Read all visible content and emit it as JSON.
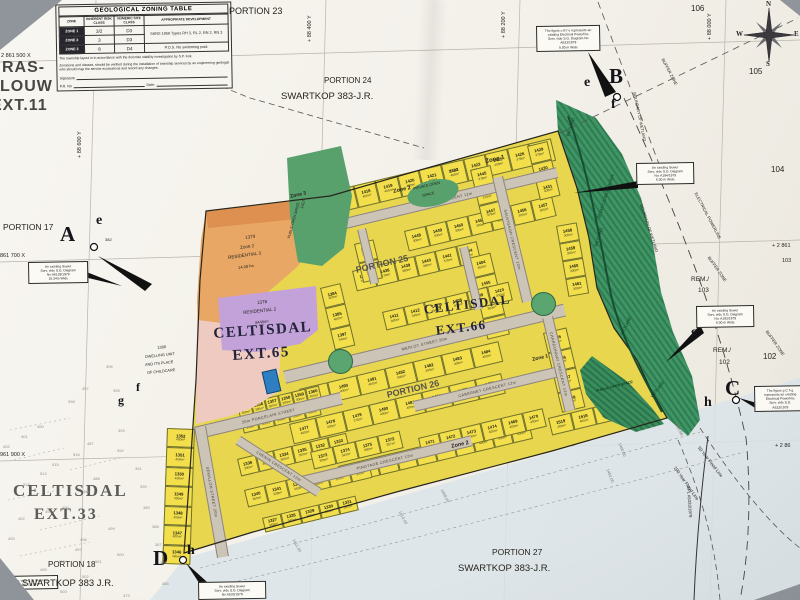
{
  "colors": {
    "plot_yellow": "#f2df4b",
    "street_grey": "#ccc4b6",
    "wetland_green": "#3f9565",
    "zone_orange": "#e9a766",
    "residential2_purple": "#c3a1d9",
    "erf1380_pink": "#efcac1",
    "open_space_green": "#58a06c",
    "special_blue": "#2e7fc2",
    "flood_wash": "#dbe4ea"
  },
  "zoning_table": {
    "title": "GEOLOGICAL ZONING TABLE",
    "col_headers": [
      "ZONE",
      "INHERENT RISK CLASS",
      "NUMERIC SITE CLASS",
      "APPROPRIATE DEVELOPMENT"
    ],
    "rows": [
      [
        "ZONE 1",
        "3/2",
        "D3"
      ],
      [
        "ZONE 2",
        "3",
        "D3"
      ],
      [
        "ZONE 3",
        "8",
        "D4"
      ]
    ],
    "dev_12": "SANS 1959 Types RH 3, RL 2, RN 2, RN 3",
    "dev_3": "P.O.S. No swimming pool.",
    "note1": "The township layout is in accordance with the dolomite stability investigation by S.P. Kok.",
    "note2": "Zonations and classes, should be verified during the installation of township services by an engineering geologist who should map the service excavations and record any changes.",
    "signature_label": "Signature",
    "pr_label": "P.R. No",
    "date_label": "Date:"
  },
  "compass": {
    "n": "N",
    "e": "E",
    "s": "S",
    "w": "W"
  },
  "labels": {
    "portion_102a": "PORTION",
    "portion_102b": "102",
    "ras1": "RAS-",
    "ras2": "LOUW",
    "ras3": "EXT.11",
    "grid_left1": "2 861 500 X",
    "grid_left2": "861 700 X",
    "grid_left3": "961 900 X",
    "grid_top1": "+ 88 600 Y",
    "grid_top2": "+ 88 400 Y",
    "grid_top3": "+ 88 200 Y",
    "grid_top4": "+ 88 000 Y",
    "grid_r1": "+ 2 861",
    "grid_r2": "103",
    "grid_r3": "+ 2 86",
    "portion_17": "PORTION 17",
    "portion_18": "PORTION 18",
    "portion_23": "PORTION 23",
    "portion_24": "PORTION 24",
    "portion_25": "PORTION 25",
    "portion_26": "PORTION 26",
    "portion_27": "PORTION 27",
    "swartkop_top": "SWARTKOP 383-J.R.",
    "swartkop_bottom": "SWARTKOP 383-J.R.",
    "swartkop_left": "SWARTKOP 383 J.R.",
    "celt33a": "CELTISDAL",
    "celt33b": "EXT.33",
    "celt65a": "CELTISDAL",
    "celt65b": "EXT.65",
    "celt66a": "CELTISDAL",
    "celt66b": "EXT.66",
    "n106": "106",
    "n105": "105",
    "n104": "104",
    "n102": "102",
    "rem103a": "REM./",
    "rem103b": "103",
    "rem102a": "REM./",
    "rem102b": "102",
    "n382": "382",
    "ha15": "15 ha",
    "flood50": "50 Year Flood Line",
    "flood100": "100 Year Flood Line",
    "epl": "EPL A5333/1979",
    "powerline": "ELECTRICAL POWERLINE",
    "buffer1": "BUFFER ZONE",
    "buffer2": "BUFFER ZONE",
    "buffer3": "BUFFER ZONE",
    "wb1": "BOUNDARY OF WETLAND",
    "wb2": "BOUNDARY OF WETLAND",
    "wet1": "WETLAND",
    "wet2": "WETLAND",
    "wet3": "WETLAND",
    "wet4": "WETLAND",
    "river": "SESMYLSPRUIT RIVER",
    "pos_wetland": "PUBLIC OPEN SPACE"
  },
  "markers": {
    "a": "A",
    "b": "B",
    "c": "C",
    "d": "D",
    "e1": "e",
    "e2": "e",
    "f1": "f",
    "f2": "f",
    "g1": "g",
    "g2": "g",
    "h1": "h",
    "h2": "h"
  },
  "zones": {
    "z3": "Zone 3",
    "z2a": "Zone 2",
    "z1a": "Zone 1",
    "z1b": "Zone 1",
    "z2b": "Zone 2",
    "orange": {
      "erf": "1379",
      "zone": "Zone 2",
      "use": "RESIDENTIAL 3",
      "size": "14.08 ha"
    },
    "purple": {
      "erf": "1378",
      "use": "RESIDENTIAL 2",
      "size": "8445m²"
    },
    "pink": {
      "erf": "1380",
      "l1": "DWELLING UNIT",
      "l2": "AND ITS PLACE",
      "l3": "OF CHILDCARE"
    },
    "pos1": "PRIVATE OPEN",
    "pos2": "SPACE",
    "erf1417": "1417",
    "public_os": "PUBLIC OPEN SPACE"
  },
  "notes": [
    {
      "lines": [
        "An existing Sewer",
        "Serv. vide S.G. Diagram",
        "No A5139/1979",
        "15.34m Wide"
      ]
    },
    {
      "lines": [
        "The figure e B f e represents an",
        "existing Electrical Powerline",
        "Serv. vide S.G. Diagram No",
        "A533/1979",
        "5.00 m Wide"
      ]
    },
    {
      "lines": [
        "An existing Sewer",
        "Serv. vide S.G. Diagram",
        "No: A184/1979",
        "6.00 m Wide"
      ]
    },
    {
      "lines": [
        "An existing Sewer",
        "Serv. vide S.G. Diagram",
        "No: A183/1979",
        "6.00 m Wide"
      ]
    },
    {
      "lines": [
        "The figure g C h g",
        "represents an existing",
        "Electrical Powerline",
        "Serv. vide S.G.",
        "A533/1979"
      ]
    },
    {
      "lines": [
        "An existing Sewer",
        "Serv. vide S.G. Diagram",
        "No A533/1979"
      ]
    },
    {
      "lines": [
        "Serv. vide S.G. Diagram",
        "No. L.1967"
      ]
    }
  ],
  "map": {
    "streets": [
      {
        "name": "SHIRAZ CRESCENT 12m"
      },
      {
        "name": "MERLOT STREET 20m"
      },
      {
        "name": "20m PORCELAIN STREET"
      },
      {
        "name": "PINOTAGE CRESCENT 12m"
      },
      {
        "name": "CABERNET CRESCENT 12m"
      },
      {
        "name": "SAUVIGNON CRESCENT 12m"
      },
      {
        "name": "CHARDONNAY CRESCENT 12m"
      },
      {
        "name": "SEMILLON STREET 20m"
      },
      {
        "name": "CHENIN CRESCENT 12m"
      },
      {
        "name": ""
      },
      {
        "name": ""
      }
    ],
    "blocks": [
      {
        "plots": [
          {
            "n": "1417",
            "a": "400m²"
          },
          {
            "n": "1418",
            "a": "400m²"
          },
          {
            "n": "1419",
            "a": "400m²"
          },
          {
            "n": "1420",
            "a": "400m²"
          },
          {
            "n": "1421",
            "a": "400m²"
          },
          {
            "n": "1422",
            "a": "400m²"
          },
          {
            "n": "1423",
            "a": "400m²"
          },
          {
            "n": "1425",
            "a": "400m²"
          },
          {
            "n": "1426",
            "a": "375m²"
          },
          {
            "n": "1427",
            "a": "375m²"
          }
        ]
      },
      {
        "plots": [
          {
            "n": "1448",
            "a": "300m²"
          },
          {
            "n": "1449",
            "a": "300m²"
          },
          {
            "n": "1450",
            "a": "300m²"
          },
          {
            "n": "1451",
            "a": "300m²"
          },
          {
            "n": "1452",
            "a": "300m²"
          },
          {
            "n": "1456",
            "a": "300m²"
          },
          {
            "n": "1457",
            "a": "300m²"
          }
        ]
      },
      {
        "plots": [
          {
            "n": "1437",
            "a": "378m²"
          },
          {
            "n": "1438",
            "a": "378m²"
          },
          {
            "n": "1439",
            "a": "360m²"
          },
          {
            "n": "1440",
            "a": "360m²"
          },
          {
            "n": "1441",
            "a": "378m²"
          },
          {
            "n": "1444",
            "a": "360m²"
          }
        ]
      },
      {
        "plots": [
          {
            "n": "1404",
            "a": "360m²"
          },
          {
            "n": "1405",
            "a": "360m²"
          },
          {
            "n": "1406",
            "a": "360m²"
          },
          {
            "n": "1407",
            "a": "378m²"
          }
        ]
      },
      {
        "plots": [
          {
            "n": "1384",
            "a": "400m²"
          },
          {
            "n": "1385",
            "a": "400m²"
          },
          {
            "n": "1397",
            "a": "344m²"
          }
        ]
      },
      {
        "plots": [
          {
            "n": "1411",
            "a": "345m²"
          },
          {
            "n": "1412",
            "a": "345m²"
          },
          {
            "n": "1413",
            "a": "345m²"
          },
          {
            "n": "1408",
            "a": "400m²"
          },
          {
            "n": "1409",
            "a": "400m²"
          },
          {
            "n": "1410",
            "a": "400m²"
          }
        ]
      },
      {
        "plots": [
          {
            "n": "1489",
            "a": "400m²"
          },
          {
            "n": "1490",
            "a": "400m²"
          },
          {
            "n": "1491",
            "a": "400m²"
          },
          {
            "n": "1492",
            "a": "400m²"
          },
          {
            "n": "1482",
            "a": "400m²"
          },
          {
            "n": "1483",
            "a": "400m²"
          },
          {
            "n": "1484",
            "a": "400m²"
          }
        ]
      },
      {
        "plots": [
          {
            "n": "1477",
            "a": "400m²"
          },
          {
            "n": "1478",
            "a": "400m²"
          },
          {
            "n": "1479",
            "a": "375m²"
          },
          {
            "n": "1480",
            "a": "400m²"
          },
          {
            "n": "1481",
            "a": "400m²"
          },
          {
            "n": "1494",
            "a": "400m²"
          },
          {
            "n": "1475",
            "a": "400m²"
          },
          {
            "n": "1476",
            "a": "400m²"
          }
        ]
      },
      {
        "plots": [
          {
            "n": "1496",
            "a": "378m²"
          },
          {
            "n": "1497",
            "a": "400m²"
          },
          {
            "n": "1498",
            "a": "400m²"
          },
          {
            "n": "1499",
            "a": "400m²"
          },
          {
            "n": "1500",
            "a": "400m²"
          },
          {
            "n": "1501",
            "a": "400m²"
          },
          {
            "n": "1502",
            "a": "400m²"
          },
          {
            "n": "1503",
            "a": "400m²"
          },
          {
            "n": "1504",
            "a": "400m²"
          },
          {
            "n": "1505",
            "a": "400m²"
          }
        ]
      },
      {
        "plots": [
          {
            "n": "1355",
            "a": "300m²"
          },
          {
            "n": "1356",
            "a": "300m²"
          },
          {
            "n": "1357",
            "a": "300m²"
          },
          {
            "n": "1358",
            "a": "300m²"
          },
          {
            "n": "1359",
            "a": "300m²"
          },
          {
            "n": "1360",
            "a": "300m²"
          }
        ]
      },
      {
        "plots": [
          {
            "n": "1361",
            "a": "300m²"
          },
          {
            "n": "1362",
            "a": "300m²"
          },
          {
            "n": "1363",
            "a": "300m²"
          },
          {
            "n": "1364",
            "a": "300m²"
          },
          {
            "n": "1365",
            "a": "300m²"
          }
        ]
      },
      {
        "plots": [
          {
            "n": "1336",
            "a": "300m²"
          },
          {
            "n": "1337",
            "a": "360m²"
          },
          {
            "n": "1334",
            "a": "360m²"
          },
          {
            "n": "1335",
            "a": "300m²"
          },
          {
            "n": "1332",
            "a": "345m²"
          },
          {
            "n": "1333",
            "a": "343m²"
          }
        ]
      },
      {
        "plots": [
          {
            "n": "1340",
            "a": "360m²"
          },
          {
            "n": "1341",
            "a": "345m²"
          },
          {
            "n": "1342",
            "a": "343m²"
          },
          {
            "n": "1343",
            "a": "345m²"
          },
          {
            "n": "1344",
            "a": "300m²"
          },
          {
            "n": "1345",
            "a": "300m²"
          }
        ]
      },
      {
        "plots": [
          {
            "n": "1327",
            "a": "345m²"
          },
          {
            "n": "1328",
            "a": "343m²"
          },
          {
            "n": "1329",
            "a": "300m²"
          },
          {
            "n": "1330",
            "a": "300m²"
          },
          {
            "n": "1331",
            "a": "300m²"
          }
        ]
      },
      {
        "plots": [
          {
            "n": "1373",
            "a": "300m²"
          },
          {
            "n": "1374",
            "a": "343m²"
          },
          {
            "n": "1375",
            "a": "300m²"
          },
          {
            "n": "1372",
            "a": "357m²"
          }
        ]
      },
      {
        "plots": [
          {
            "n": "1471",
            "a": "400m²"
          },
          {
            "n": "1472",
            "a": "400m²"
          },
          {
            "n": "1473",
            "a": "400m²"
          },
          {
            "n": "1474",
            "a": "400m²"
          },
          {
            "n": "1469",
            "a": "400m²"
          },
          {
            "n": "1470",
            "a": "400m²"
          }
        ]
      },
      {
        "plots": [
          {
            "n": "1519",
            "a": "400m²"
          },
          {
            "n": "1518",
            "a": "400m²"
          },
          {
            "n": "1511",
            "a": "400m²"
          },
          {
            "n": "1510",
            "a": "400m²"
          }
        ]
      },
      {
        "plots": [
          {
            "n": "1352",
            "a": "400m²"
          },
          {
            "n": "1351",
            "a": "450m²"
          },
          {
            "n": "1350",
            "a": "400m²"
          },
          {
            "n": "1349",
            "a": "400m²"
          },
          {
            "n": "1348",
            "a": "450m²"
          },
          {
            "n": "1347",
            "a": "400m²"
          },
          {
            "n": "1346",
            "a": "495m²"
          }
        ]
      },
      {
        "plots": [
          {
            "n": "1485",
            "a": "400m²"
          },
          {
            "n": "1486",
            "a": "400m²"
          },
          {
            "n": "1487",
            "a": "400m²"
          },
          {
            "n": "1488",
            "a": "400m²"
          }
        ]
      },
      {
        "plots": [
          {
            "n": "1429",
            "a": "375m²"
          },
          {
            "n": "1430",
            "a": "400m²"
          },
          {
            "n": "1431",
            "a": "400m²"
          }
        ]
      },
      {
        "plots": [
          {
            "n": "1445",
            "a": "378m²"
          },
          {
            "n": "1446",
            "a": "378m²"
          },
          {
            "n": "1447",
            "a": "378m²"
          }
        ]
      },
      {
        "plots": [
          {
            "n": "1458",
            "a": "300m²"
          },
          {
            "n": "1459",
            "a": "300m²"
          },
          {
            "n": "1460",
            "a": "300m²"
          },
          {
            "n": "1461",
            "a": "300m²"
          }
        ]
      },
      {
        "plots": [
          {
            "n": "1442",
            "a": "378m²"
          },
          {
            "n": "1443",
            "a": "378m²"
          }
        ]
      }
    ],
    "contours": [
      "1411.00",
      "1410.00",
      "1408.00",
      "1402.00",
      "1400.00",
      "1398.00"
    ],
    "faint_numbers": [
      "395",
      "396",
      "397",
      "398",
      "393",
      "392",
      "391",
      "390",
      "389",
      "388",
      "387",
      "386",
      "385",
      "373",
      "400",
      "401",
      "402",
      "487",
      "516",
      "515",
      "514",
      "513",
      "488",
      "489",
      "490",
      "491",
      "492",
      "493",
      "496",
      "497",
      "498",
      "499",
      "500",
      "501",
      "502",
      "503",
      "495"
    ]
  }
}
